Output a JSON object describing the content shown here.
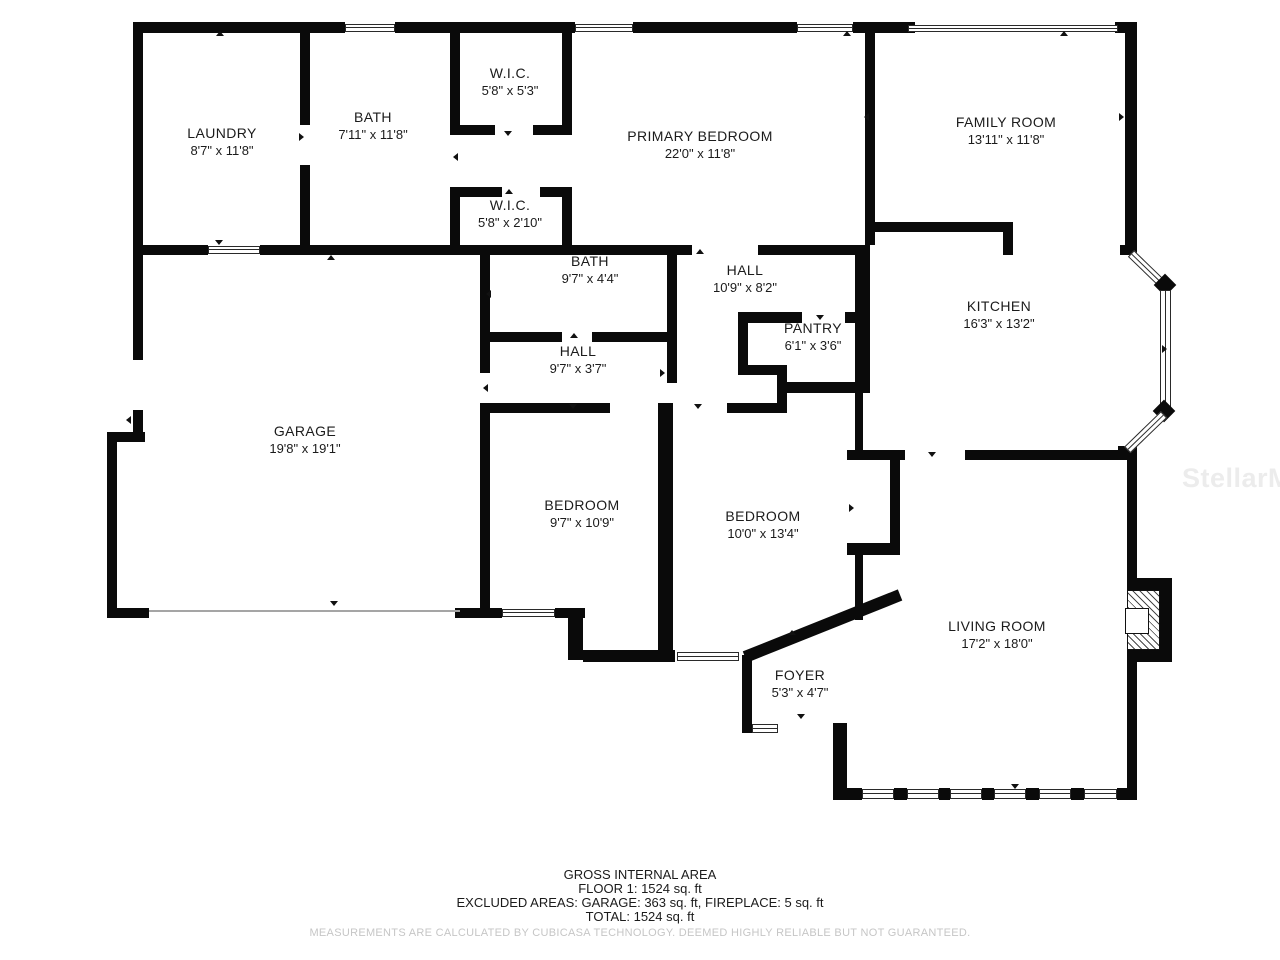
{
  "title": "Floor plan",
  "colors": {
    "background": "#ffffff",
    "walls": "#0a0a0a",
    "text": "#1b1b1b",
    "disclaimer_text": "#c6c6c6",
    "watermark": "#ececec"
  },
  "icons": {
    "door_arrow": "small black triangle marking a door/opening direction",
    "window": "double-line white band in wall",
    "fireplace": "hatched square on living room wall"
  },
  "watermark": {
    "text": "StellarMLS"
  },
  "rooms": [
    {
      "name": "LAUNDRY",
      "dims": "8'7\" x 11'8\""
    },
    {
      "name": "BATH",
      "dims": "7'11\" x 11'8\""
    },
    {
      "name": "W.I.C.",
      "dims": "5'8\" x 5'3\""
    },
    {
      "name": "PRIMARY BEDROOM",
      "dims": "22'0\" x 11'8\""
    },
    {
      "name": "FAMILY ROOM",
      "dims": "13'11\" x 11'8\""
    },
    {
      "name": "W.I.C.",
      "dims": "5'8\" x 2'10\""
    },
    {
      "name": "BATH",
      "dims": "9'7\" x 4'4\""
    },
    {
      "name": "HALL",
      "dims": "10'9\" x 8'2\""
    },
    {
      "name": "KITCHEN",
      "dims": "16'3\" x 13'2\""
    },
    {
      "name": "PANTRY",
      "dims": "6'1\" x 3'6\""
    },
    {
      "name": "HALL",
      "dims": "9'7\" x 3'7\""
    },
    {
      "name": "GARAGE",
      "dims": "19'8\" x 19'1\""
    },
    {
      "name": "BEDROOM",
      "dims": "9'7\" x 10'9\""
    },
    {
      "name": "BEDROOM",
      "dims": "10'0\" x 13'4\""
    },
    {
      "name": "LIVING ROOM",
      "dims": "17'2\" x 18'0\""
    },
    {
      "name": "FOYER",
      "dims": "5'3\" x 4'7\""
    }
  ],
  "footer": {
    "line1": "GROSS INTERNAL AREA",
    "line2": "FLOOR 1: 1524 sq. ft",
    "line3": "EXCLUDED AREAS: GARAGE: 363 sq. ft, FIREPLACE: 5 sq. ft",
    "line4": "TOTAL: 1524 sq. ft",
    "disclaimer": "MEASUREMENTS ARE CALCULATED BY CUBICASA TECHNOLOGY. DEEMED HIGHLY RELIABLE BUT NOT GUARANTEED."
  }
}
